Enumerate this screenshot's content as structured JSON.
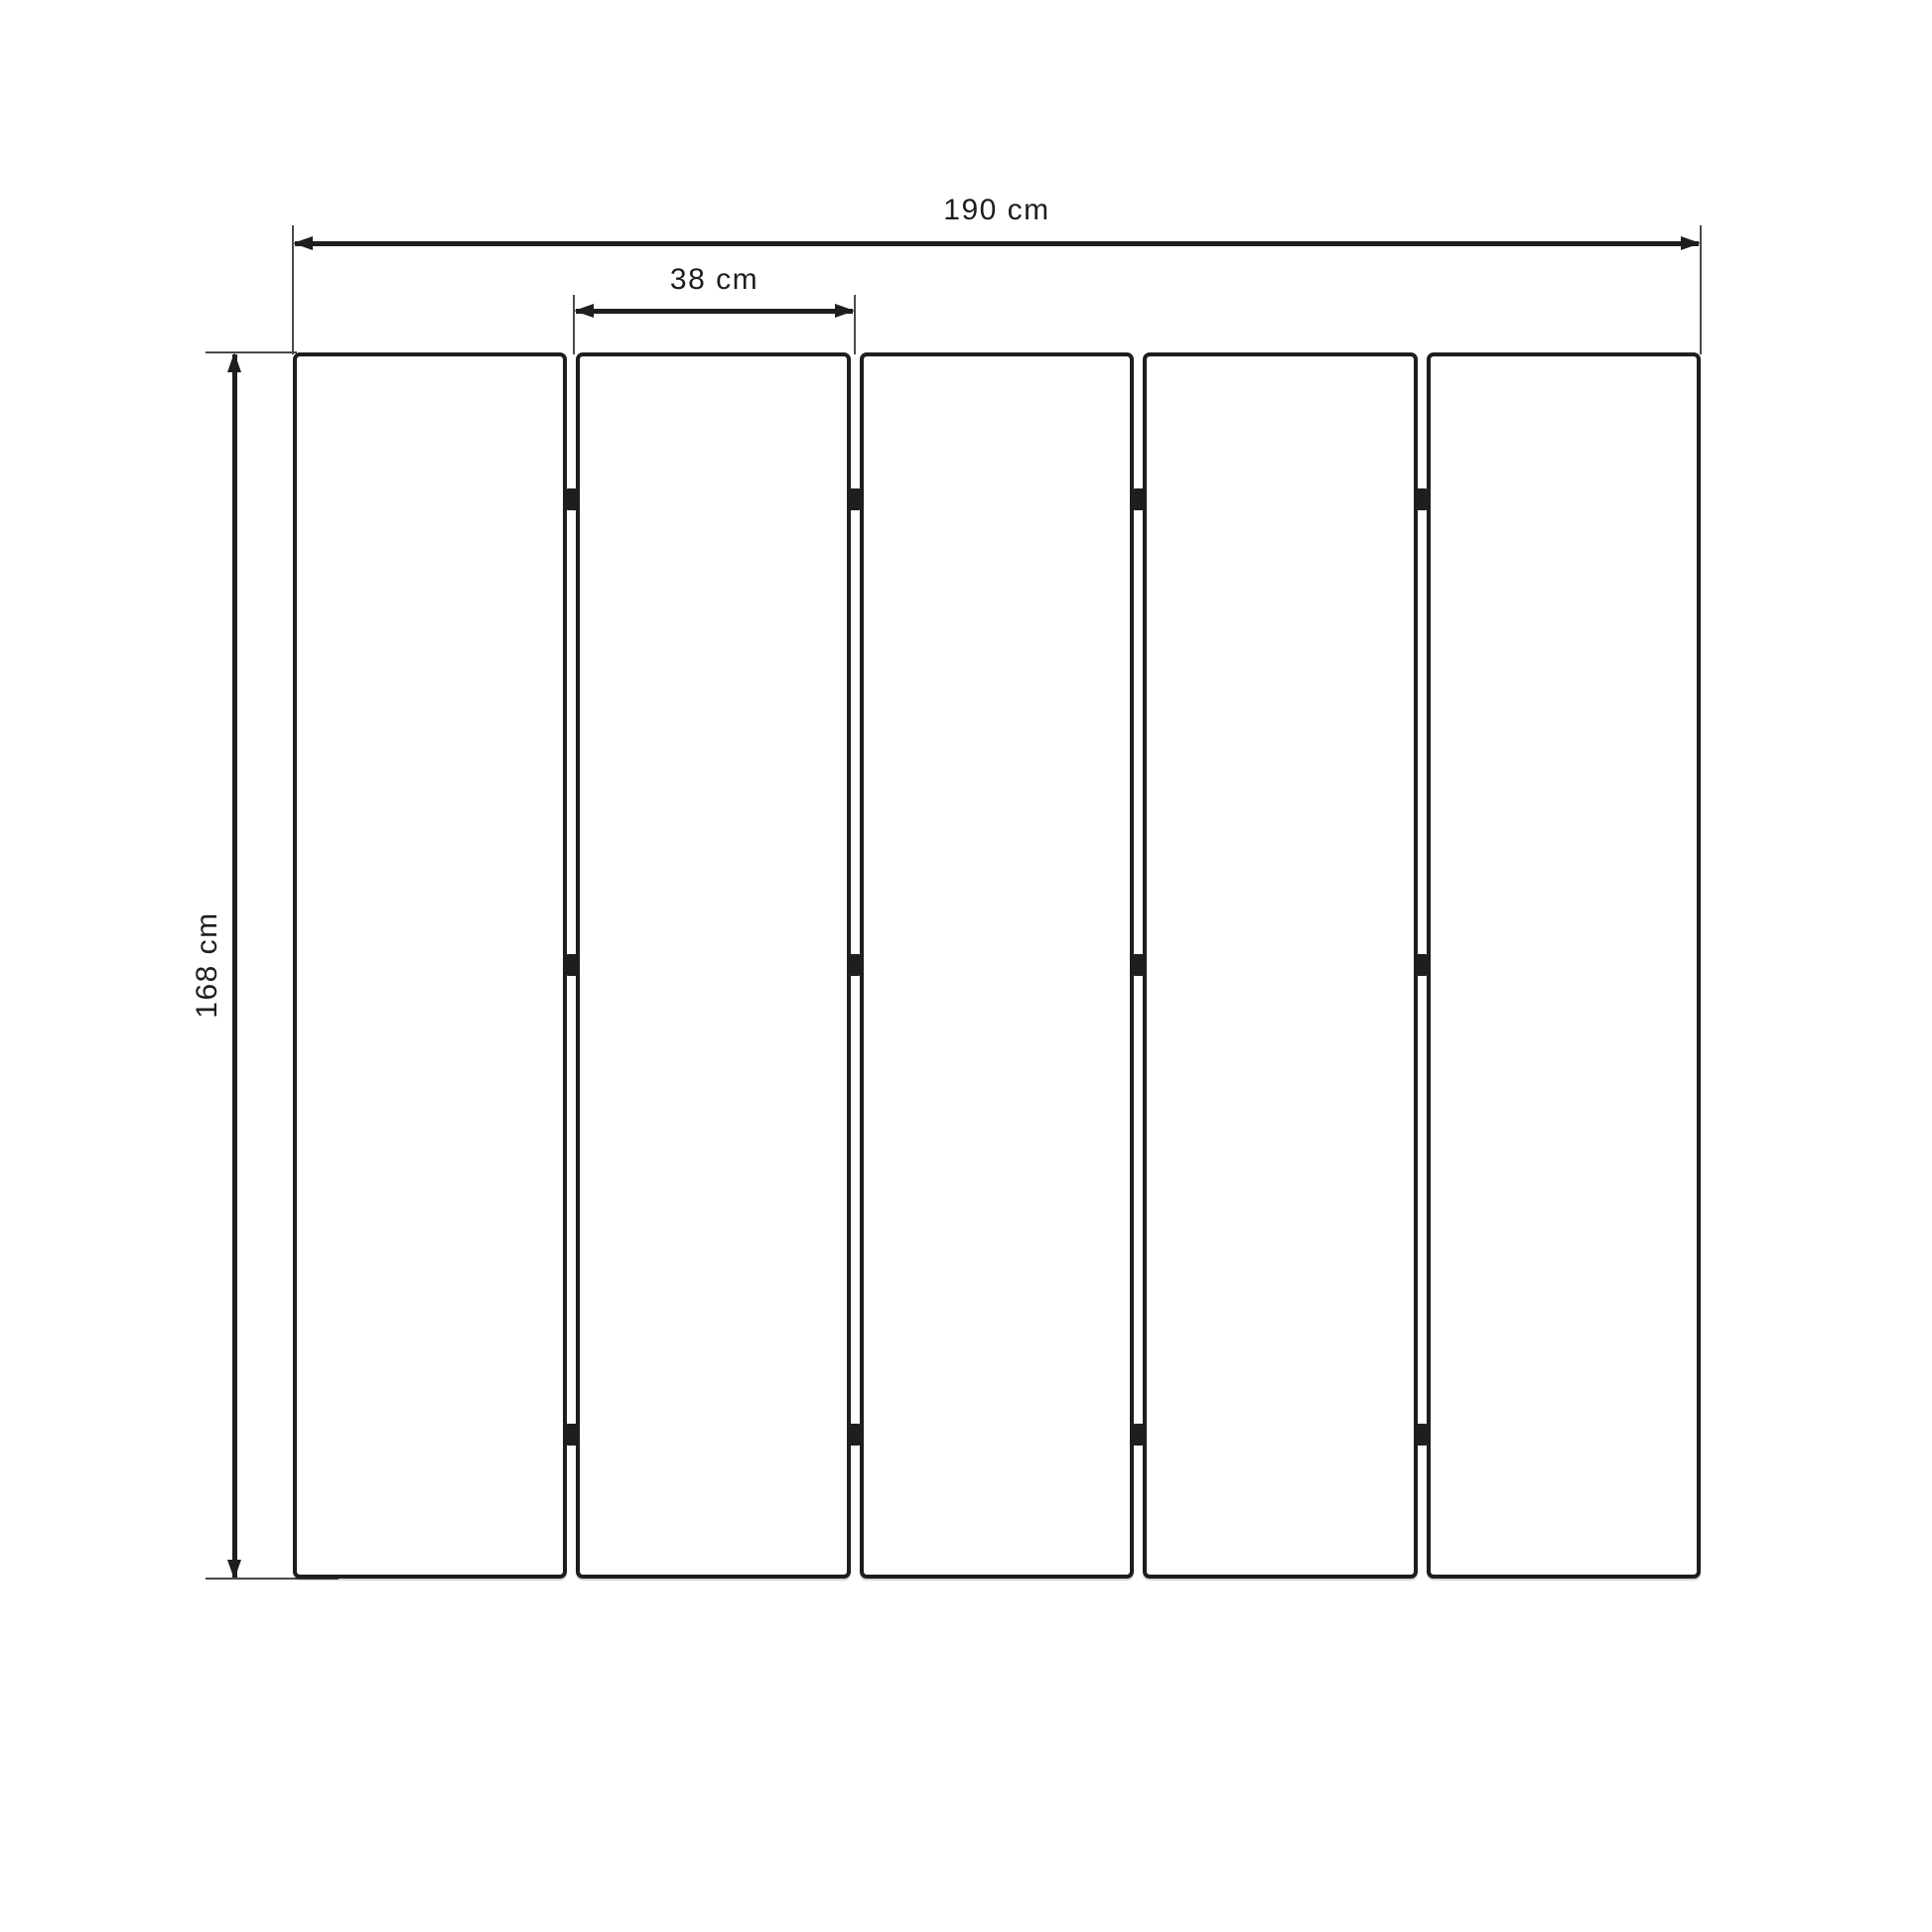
{
  "diagram": {
    "type": "technical-dimension-drawing",
    "panel_count": 5,
    "hinges_per_gap": 3,
    "colors": {
      "line": "#1e1e1e",
      "extension_line": "#4a4a4a",
      "background": "#ffffff"
    },
    "dimensions": {
      "overall_width": {
        "label": "190 cm"
      },
      "panel_width": {
        "label": "38 cm"
      },
      "height": {
        "label": "168 cm"
      }
    }
  }
}
